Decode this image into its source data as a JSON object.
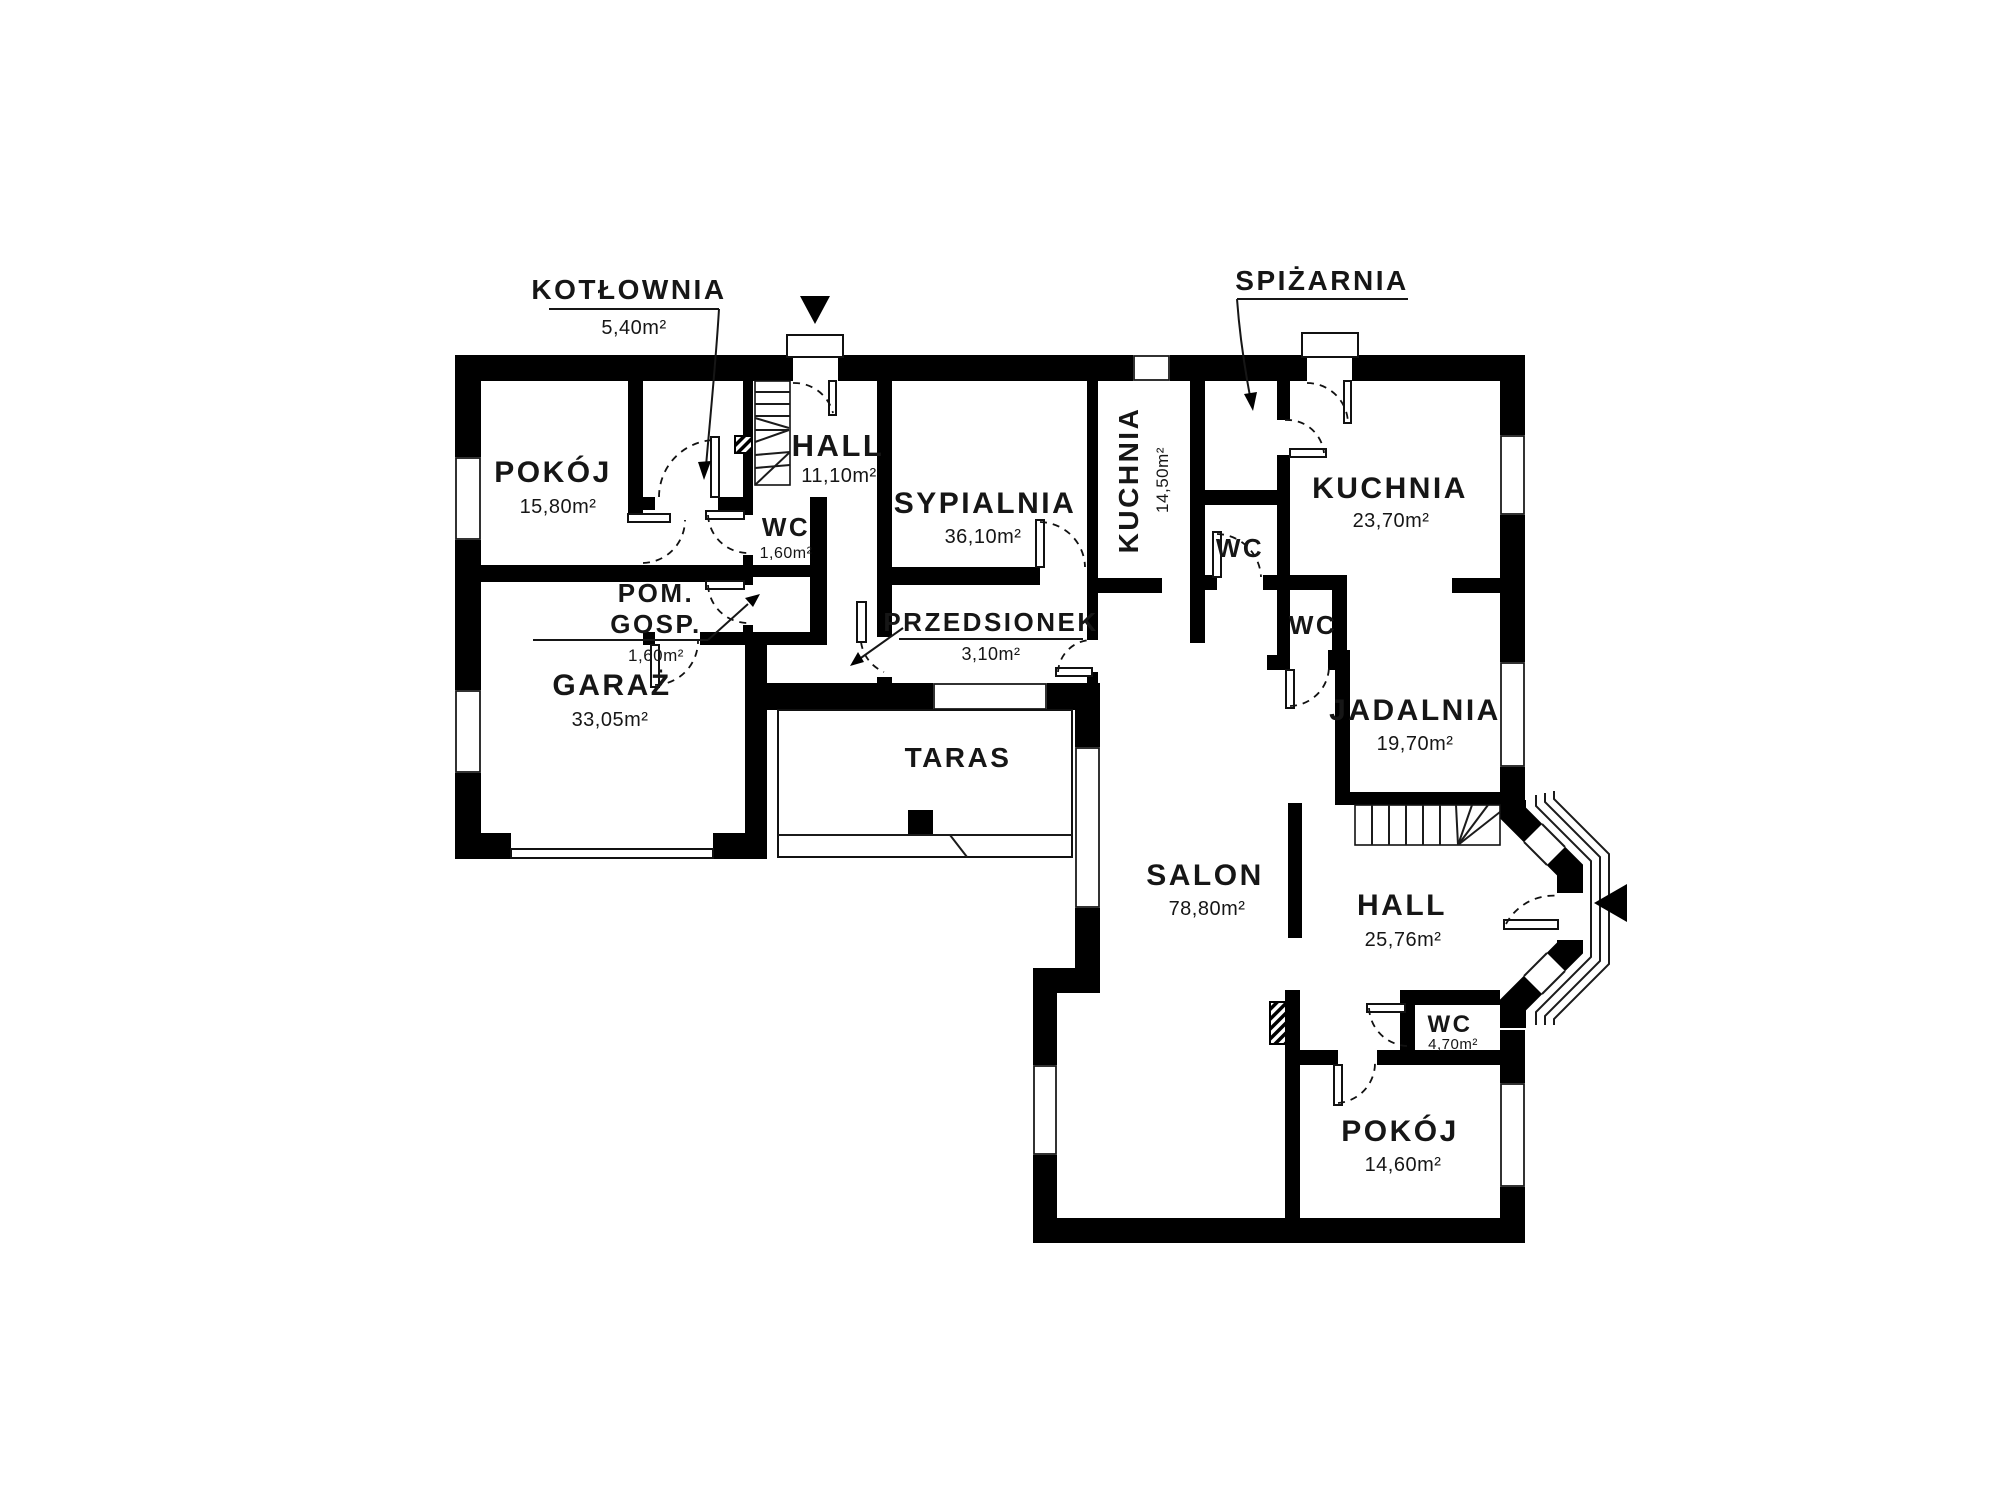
{
  "plan": {
    "type": "floor-plan",
    "background_color": "#ffffff",
    "wall_color": "#000000",
    "text_color": "#161616",
    "rooms": {
      "kotlownia": {
        "name": "KOTŁOWNIA",
        "area": "5,40m²"
      },
      "pokoj_gora": {
        "name": "POKÓJ",
        "area": "15,80m²"
      },
      "hall_gora": {
        "name": "HALL",
        "area": "11,10m²"
      },
      "wc_hall": {
        "name": "WC",
        "area": "1,60m²"
      },
      "pom_gosp": {
        "name_line1": "POM.",
        "name_line2": "GOSP.",
        "area": "1,60m²"
      },
      "sypialnia": {
        "name": "SYPIALNIA",
        "area": "36,10m²"
      },
      "przedsionek": {
        "name": "PRZEDSIONEK",
        "area": "3,10m²"
      },
      "kuchnia_mala": {
        "name": "KUCHNIA",
        "area": "14,50m²"
      },
      "wc_kuchnia": {
        "name": "WC"
      },
      "spizarnia": {
        "name": "SPIŻARNIA"
      },
      "kuchnia_duza": {
        "name": "KUCHNIA",
        "area": "23,70m²"
      },
      "wc_srodek": {
        "name": "WC"
      },
      "garaz": {
        "name": "GARAŻ",
        "area": "33,05m²"
      },
      "taras": {
        "name": "TARAS"
      },
      "jadalnia": {
        "name": "JADALNIA",
        "area": "19,70m²"
      },
      "salon": {
        "name": "SALON",
        "area": "78,80m²"
      },
      "hall_dol": {
        "name": "HALL",
        "area": "25,76m²"
      },
      "wc_dol": {
        "name": "WC",
        "area": "4,70m²"
      },
      "pokoj_dol": {
        "name": "POKÓJ",
        "area": "14,60m²"
      }
    }
  }
}
